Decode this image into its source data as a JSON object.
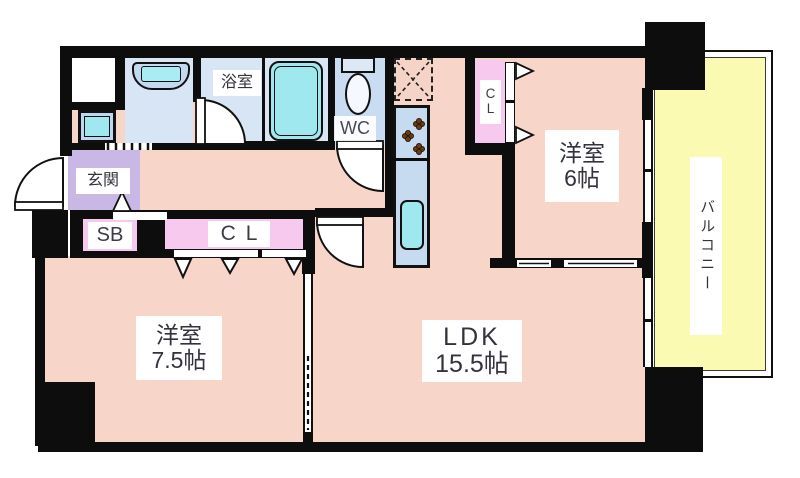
{
  "floorplan": {
    "type": "japanese-apartment-floor-plan",
    "rooms": {
      "entrance": {
        "label": "玄関"
      },
      "shoe_box": {
        "label": "SB"
      },
      "hall_closet": {
        "label": "CL"
      },
      "bathroom": {
        "label": "浴室"
      },
      "toilet": {
        "label": "WC"
      },
      "bedroom_closet": {
        "line1": "C",
        "line2": "L"
      },
      "bedroom_east": {
        "label": "洋室",
        "size": "6帖"
      },
      "bedroom_west": {
        "label": "洋室",
        "size": "7.5帖"
      },
      "living": {
        "label": "LDK",
        "size": "15.5帖"
      },
      "balcony": {
        "label": "バルコニー"
      }
    },
    "colors": {
      "wall": "#0d0d0d",
      "room_pink": "#f8d5c9",
      "entrance_purple": "#c9b7e5",
      "closet_pink": "#f7c9ef",
      "wet_area_blue": "#d7e5f4",
      "counter_blue": "#c6daf0",
      "fixture_cyan": "#a0e8f0",
      "balcony_yellow": "#fafab2"
    }
  }
}
